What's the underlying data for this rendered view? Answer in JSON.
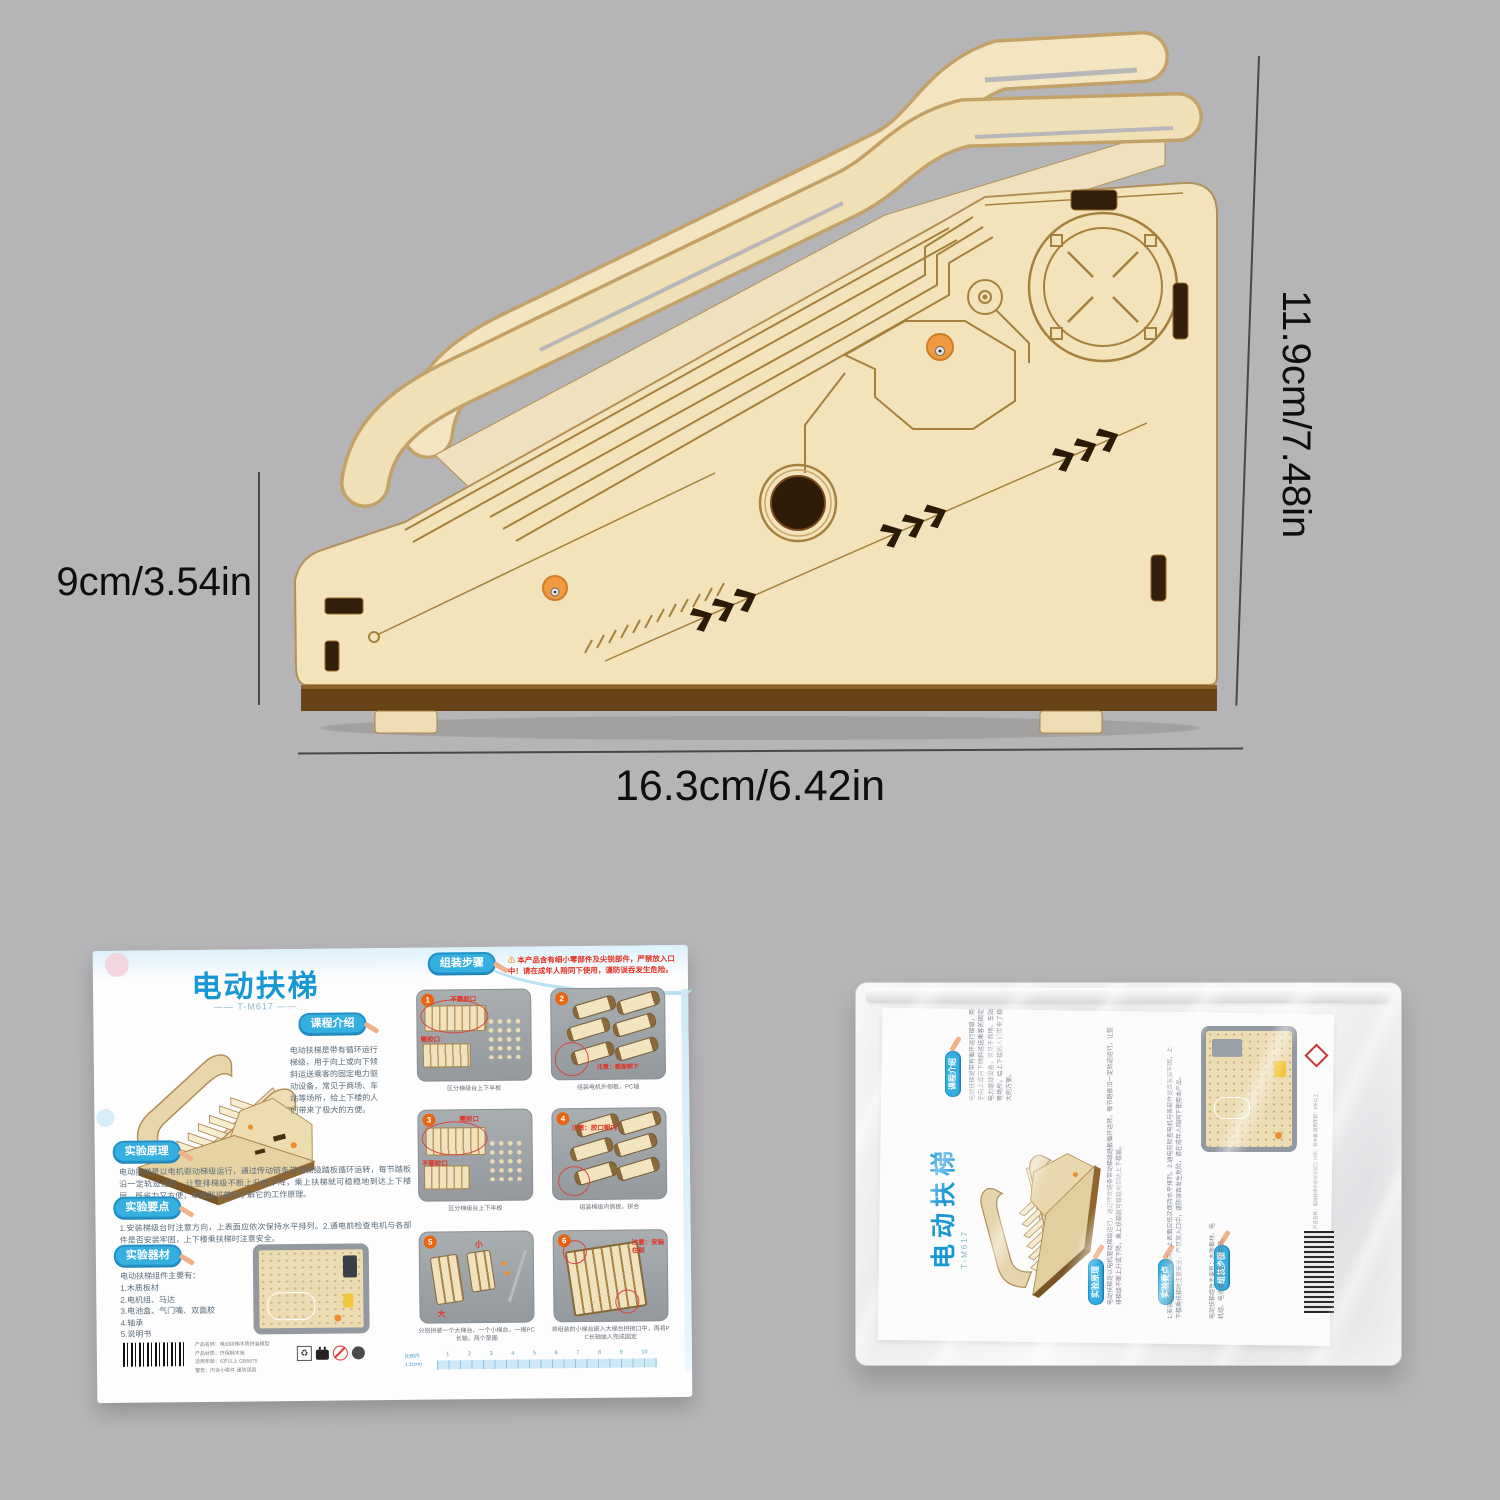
{
  "colors": {
    "background": "#b5b4b6",
    "wood": "#f2e3ba",
    "wood_dark": "#6a4218",
    "accent_blue": "#35aee0",
    "title_blue": "#1897d5",
    "warning_red": "#e23222",
    "peg_orange": "#f09a40"
  },
  "dims": {
    "right": "11.9cm/7.48in",
    "left": "9cm/3.54in",
    "bottom": "16.3cm/6.42in"
  },
  "manual": {
    "title": "电动扶梯",
    "model_line": "—— T-M617 ——",
    "sections": {
      "intro": {
        "badge": "课程介绍",
        "text": "电动扶梯是带有循环运行梯级，用于向上或向下倾斜运送乘客的固定电力驱动设备，常见于商场、车站等场所，给上下楼的人们带来了极大的方便。"
      },
      "principle": {
        "badge": "实验原理",
        "text": "电动扶梯是以电机驱动梯级运行，通过传动链条带动梯级踏板循环运转，每节踏板沿一定轨迹运行，让整排梯级不断上升或下降，乘上扶梯就可稳稳地到达上下楼层，既省力又方便，本模型将带你了解它的工作原理。"
      },
      "points": {
        "badge": "实验要点",
        "text": "1.安装梯级台时注意方向，上表面应依次保持水平排列。2.通电前检查电机与各部件是否安装牢固，上下楼乘扶梯时注意安全。"
      },
      "materials": {
        "badge": "实验器材",
        "intro": "电动扶梯组件主要有：",
        "items": [
          "1.木质板材",
          "2.电机组、马达",
          "3.电池盒、气门嘴、双面胶",
          "4.轴承",
          "5.说明书"
        ]
      }
    },
    "assembly": {
      "badge": "组装步骤",
      "warning_icon": "⚠",
      "warning": "本产品含有细小零部件及尖锐部件，严禁放入口中！请在成年人陪同下使用，谨防误吞发生危险。"
    },
    "steps": [
      {
        "num": "1",
        "n1": "不要胶口",
        "n2": "需胶口",
        "caption": "区分梯级台上下半板"
      },
      {
        "num": "2",
        "n1": "注意：截面朝下",
        "n2": "",
        "caption": "组装电机外侧板，PC轴"
      },
      {
        "num": "3",
        "n1": "需胶口",
        "n2": "不要胶口",
        "caption": "区分梯级台上下半板"
      },
      {
        "num": "4",
        "n1": "注意：胶口朝内",
        "n2": "",
        "caption": "组装梯级内侧板，拼合"
      },
      {
        "num": "5",
        "n1": "大",
        "n2": "小",
        "caption": "分别拼装一个大梯台、一个小梯台，一根PC长轴，两个垫圈"
      },
      {
        "num": "6",
        "n1": "注意：安装在前",
        "n2": "",
        "caption": "将组装的小梯台嵌入大梯台拼接口中，再将PC长轴插入完成固定"
      }
    ],
    "ruler": {
      "label1": "比例尺",
      "label2": "1:1(cm)",
      "numbers": [
        "1",
        "2",
        "3",
        "4",
        "5",
        "6",
        "7",
        "8",
        "9",
        "10"
      ]
    },
    "barcode_lines": [
      "产品名称：电动扶梯木质拼装模型",
      "产品材质：环保椴木板",
      "适用年龄：6岁以上 GB6675",
      "警告：内含小零件 谨防误吞"
    ],
    "icons": [
      "recycle-box-icon",
      "plug-icon",
      "prohibition-icon",
      "certification-dot-icon"
    ]
  },
  "pkg": {
    "title": "电动扶梯",
    "model_line": "T-M617",
    "badges": [
      "课程介绍",
      "实验原理",
      "实验要点",
      "组装步骤"
    ],
    "cols": [
      "电动扶梯是带有循环运行梯级，用于向上或向下倾斜运送乘客的固定电力驱动设备，常见于商场、车站等场所，给上下楼的人们带来了极大的方便。",
      "电动扶梯是以电机驱动梯级运行，通过传动链条带动梯级踏板循环运转，每节踏板沿一定轨迹运行，让整排梯级不断上升或下降，乘上扶梯就可稳稳地到达上下楼层。",
      "1.安装梯级台时注意方向，上表面应依次保持水平排列。2.通电前检查电机与各部件是否安装牢固，上下楼乘扶梯时注意安全，严禁放入口中，谨防误吞发生危险，请在成年人陪同下使用本产品。",
      "电动扶梯组件主要有：木质板材、电机组、电池盒、轴承、说明书。"
    ],
    "side_text": "产品名称：电动扶梯木质拼装模型 材质：椴木板 适用年龄：6岁以上"
  }
}
